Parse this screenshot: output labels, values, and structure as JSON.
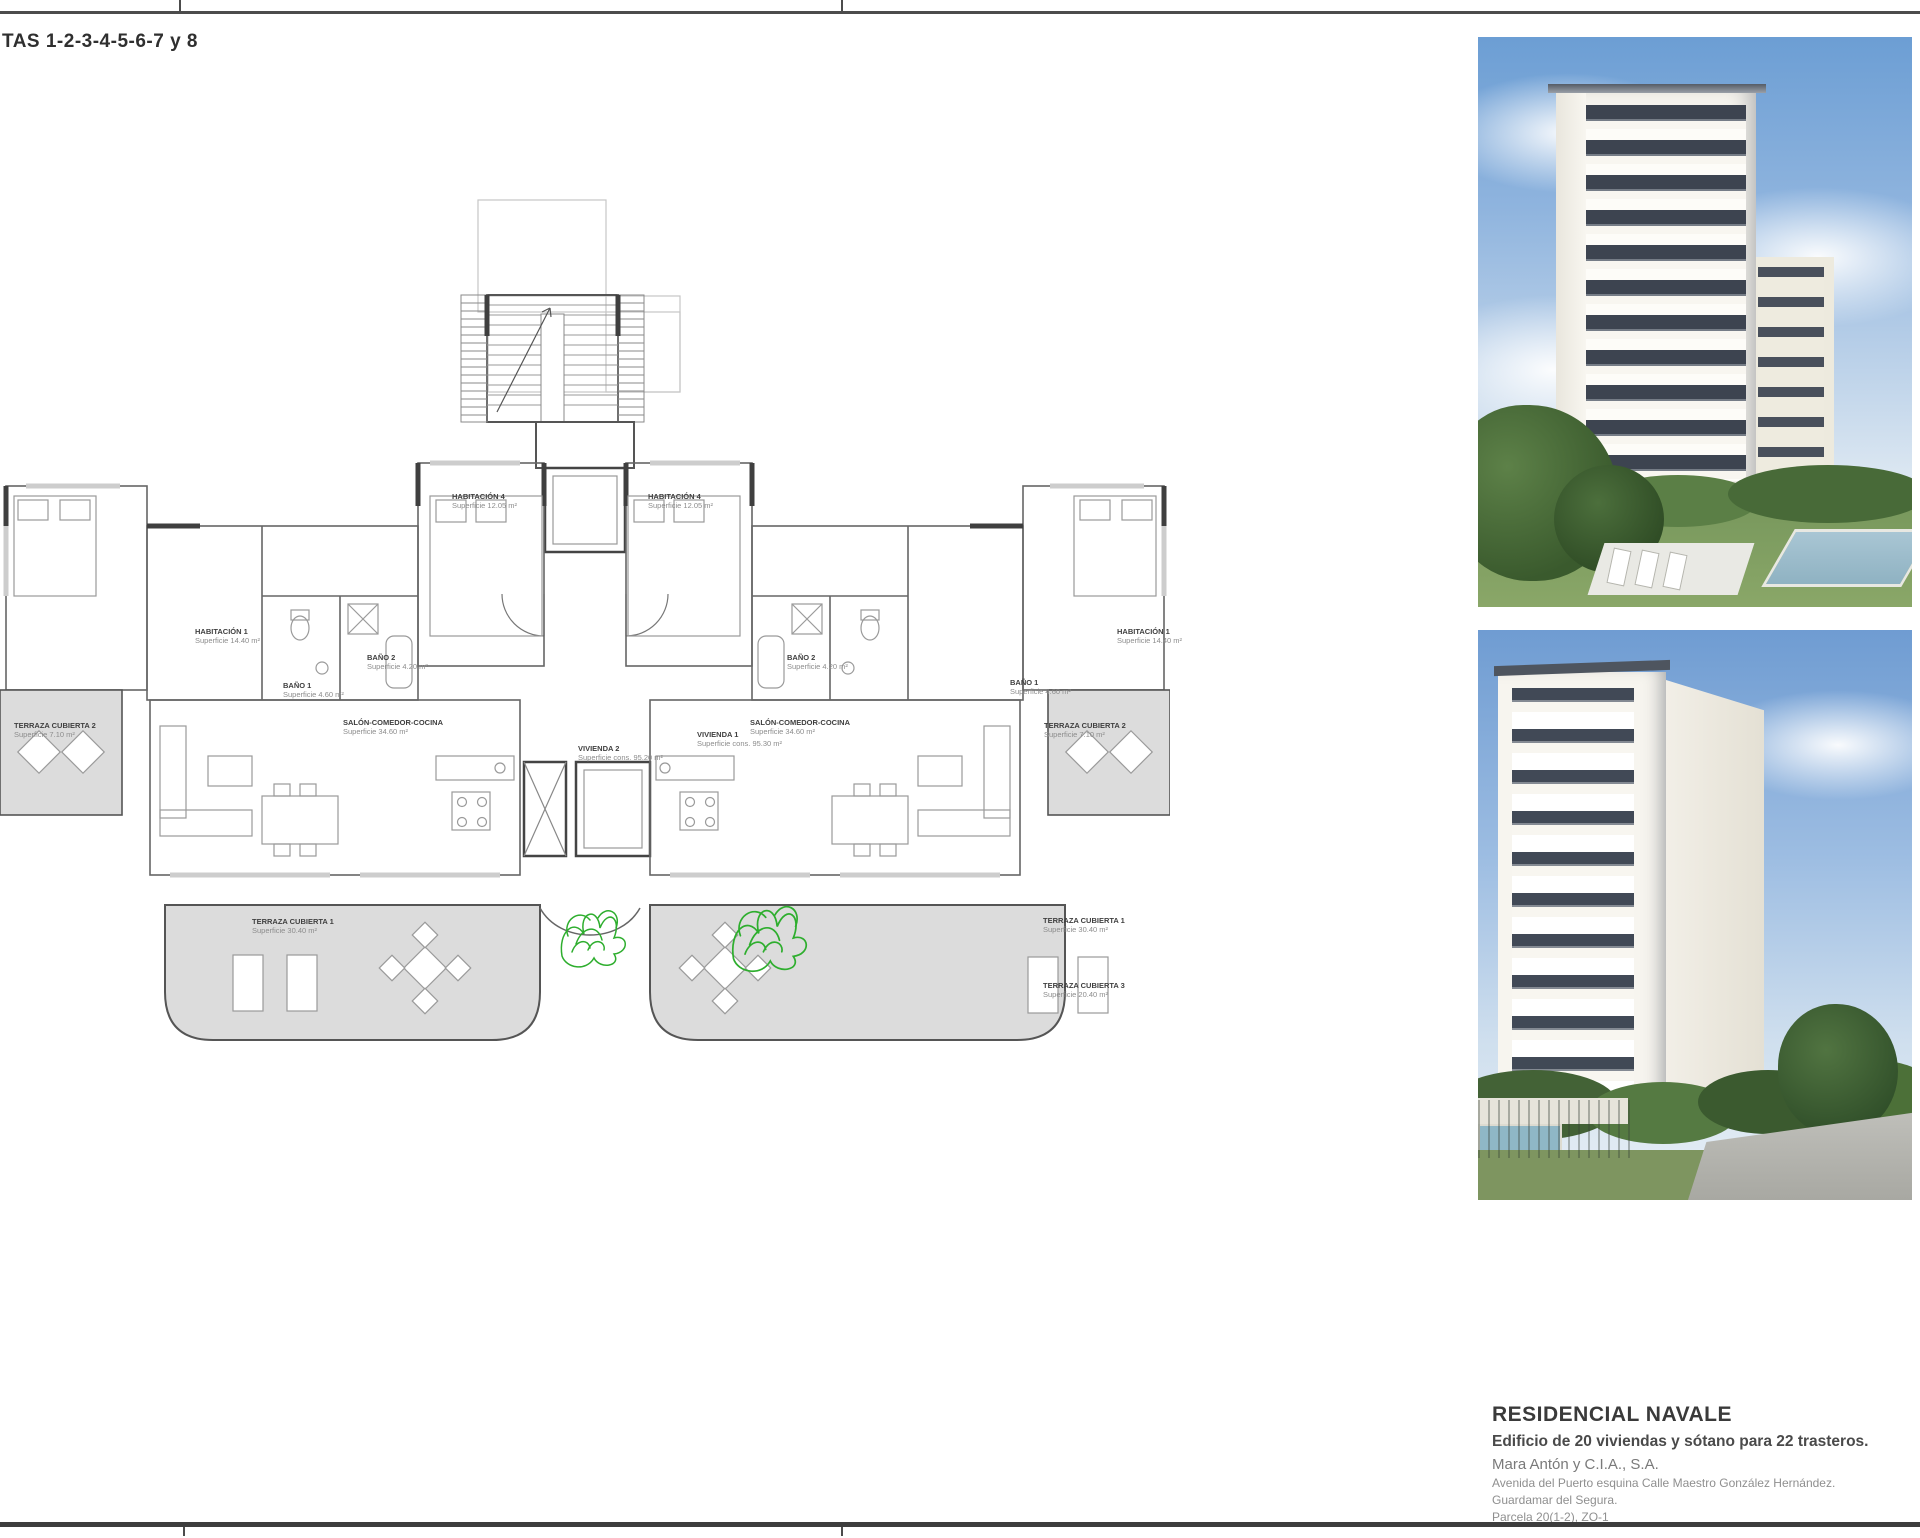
{
  "header": {
    "sheet_title": "TAS 1-2-3-4-5-6-7 y 8"
  },
  "plan": {
    "labels": [
      {
        "id": "habitacion4-left",
        "lines": [
          "HABITACIÓN 4",
          "Superficie 12.05 m²"
        ],
        "x": 452,
        "y": 492
      },
      {
        "id": "habitacion4-right",
        "lines": [
          "HABITACIÓN 4",
          "Superficie 12.05 m²"
        ],
        "x": 648,
        "y": 492
      },
      {
        "id": "habitacion1-left",
        "lines": [
          "HABITACIÓN 1",
          "Superficie 14.40 m²"
        ],
        "x": 195,
        "y": 627
      },
      {
        "id": "habitacion1-right",
        "lines": [
          "HABITACIÓN 1",
          "Superficie 14.40 m²"
        ],
        "x": 1117,
        "y": 627
      },
      {
        "id": "bano1-left",
        "lines": [
          "BAÑO 1",
          "Superficie 4.60 m²"
        ],
        "x": 283,
        "y": 681
      },
      {
        "id": "bano1-right",
        "lines": [
          "BAÑO 1",
          "Superficie 4.60 m²"
        ],
        "x": 1010,
        "y": 678
      },
      {
        "id": "bano2-left",
        "lines": [
          "BAÑO 2",
          "Superficie 4.20 m²"
        ],
        "x": 367,
        "y": 653
      },
      {
        "id": "bano2-right",
        "lines": [
          "BAÑO 2",
          "Superficie 4.20 m²"
        ],
        "x": 787,
        "y": 653
      },
      {
        "id": "salon-left",
        "lines": [
          "SALÓN-COMEDOR-COCINA",
          "Superficie 34.60 m²"
        ],
        "x": 343,
        "y": 718
      },
      {
        "id": "salon-right",
        "lines": [
          "SALÓN-COMEDOR-COCINA",
          "Superficie 34.60 m²"
        ],
        "x": 750,
        "y": 718
      },
      {
        "id": "terraza2-left",
        "lines": [
          "TERRAZA CUBIERTA 2",
          "Superficie 7.10 m²"
        ],
        "x": 14,
        "y": 721
      },
      {
        "id": "terraza2-right",
        "lines": [
          "TERRAZA CUBIERTA 2",
          "Superficie 7.10 m²"
        ],
        "x": 1044,
        "y": 721
      },
      {
        "id": "vivienda2",
        "lines": [
          "VIVIENDA 2",
          "Superficie cons. 95.20 m²"
        ],
        "x": 578,
        "y": 744
      },
      {
        "id": "vivienda1",
        "lines": [
          "VIVIENDA 1",
          "Superficie cons. 95.30 m²"
        ],
        "x": 697,
        "y": 730
      },
      {
        "id": "terraza1-left",
        "lines": [
          "TERRAZA CUBIERTA 1",
          "Superficie 30.40 m²"
        ],
        "x": 252,
        "y": 917
      },
      {
        "id": "terraza1-right",
        "lines": [
          "TERRAZA CUBIERTA 1",
          "Superficie 30.40 m²"
        ],
        "x": 1043,
        "y": 916
      },
      {
        "id": "terraza3-right",
        "lines": [
          "TERRAZA CUBIERTA 3",
          "Superficie 20.40 m²"
        ],
        "x": 1043,
        "y": 981
      }
    ]
  },
  "photos": {
    "top": {
      "caption": "White residential tower render with garden, trees and pool"
    },
    "bottom": {
      "caption": "Corner view render of white residential tower with street and pool"
    }
  },
  "project": {
    "name": "RESIDENCIAL NAVALE",
    "description": "Edificio de 20 viviendas y sótano para 22 trasteros.",
    "developer": "Mara Antón y C.I.A., S.A.",
    "address_line1": "Avenida del Puerto esquina Calle Maestro González Hernández.",
    "address_line2": "Guardamar del Segura.",
    "address_line3": "Parcela 20(1-2), ZO-1"
  },
  "colors": {
    "border_line": "#4c4c4c",
    "plan_wall": "#666666",
    "terrace_fill": "#dcdcdc",
    "plant_green": "#2eae2e",
    "sky_blue": "#8fb4de"
  }
}
